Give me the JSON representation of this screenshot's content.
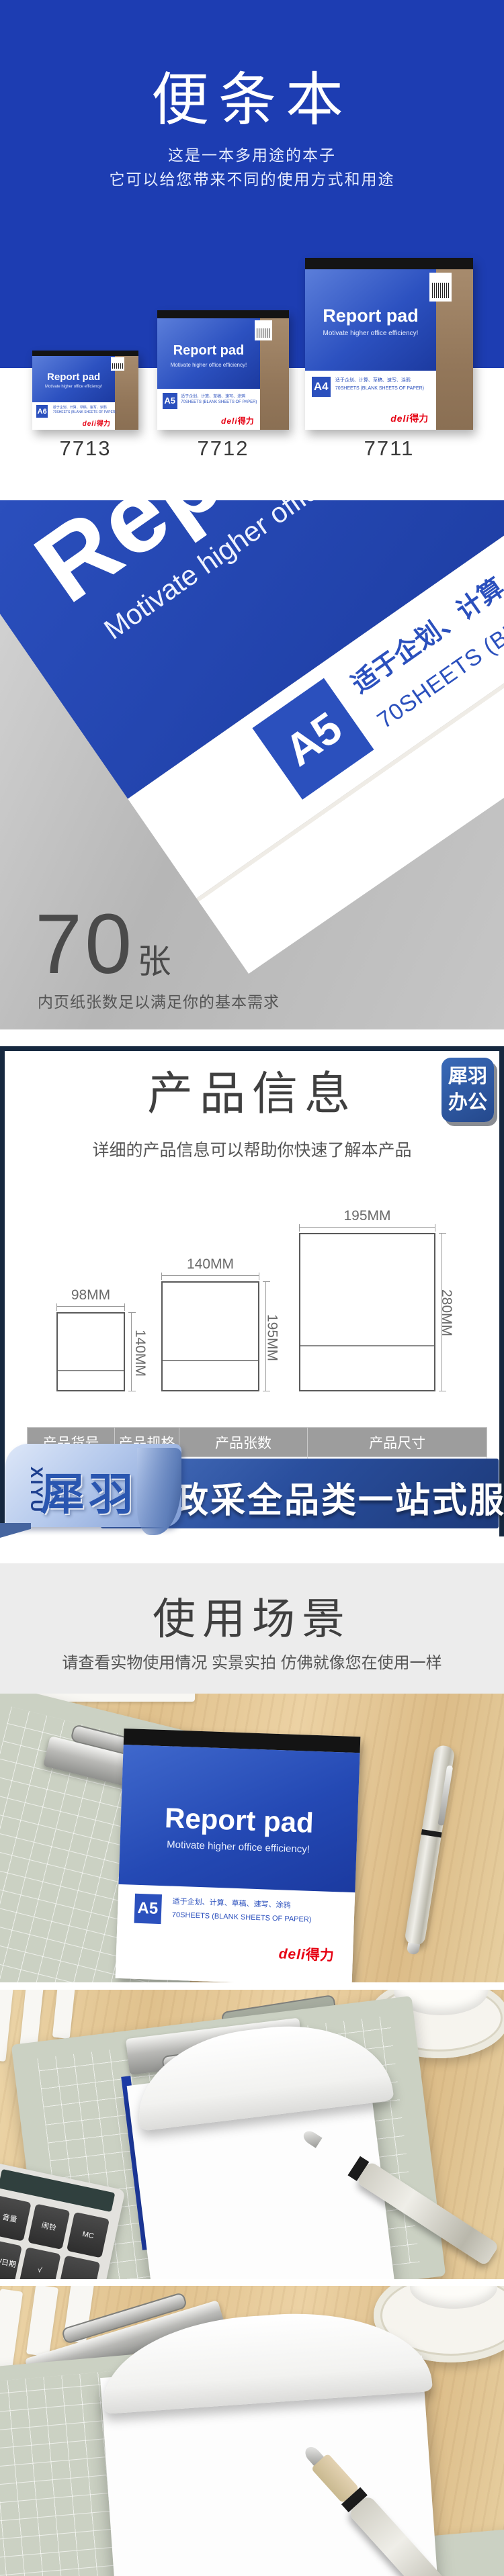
{
  "hero": {
    "title": "便条本",
    "subtitle1": "这是一本多用途的本子",
    "subtitle2": "它可以给您带来不同的使用方式和用途"
  },
  "product": {
    "cover_title": "Report pad",
    "cover_tagline": "Motivate higher office efficiency!",
    "usage_line": "适于企划、计算、草稿、速写、涂鸦",
    "sheets_line": "70SHEETS (BLANK SHEETS OF PAPER)",
    "brand_en": "deli",
    "brand_cn": "得力"
  },
  "models": [
    {
      "code": "7713",
      "size": "A6"
    },
    {
      "code": "7712",
      "size": "A5"
    },
    {
      "code": "7711",
      "size": "A4"
    }
  ],
  "feature": {
    "count": "70",
    "unit": "张",
    "desc": "内页纸张数足以满足你的基本需求",
    "badge_size": "A5"
  },
  "info": {
    "title": "产品信息",
    "subtitle": "详细的产品信息可以帮助你快速了解本产品",
    "badge_line1": "犀羽",
    "badge_line2": "办公"
  },
  "diagram": {
    "sizes": [
      {
        "w": "98MM",
        "h": "140MM"
      },
      {
        "w": "140MM",
        "h": "195MM"
      },
      {
        "w": "195MM",
        "h": "280MM"
      }
    ]
  },
  "spec_table": {
    "headers": [
      "产品货号",
      "产品规格",
      "产品张数",
      "产品尺寸"
    ],
    "row": [
      "",
      "",
      "70张/本",
      "195 X 280"
    ]
  },
  "banner": {
    "brand_vertical": "XIYU",
    "brand": "犀羽",
    "slogan": "政采全品类一站式服务"
  },
  "scene": {
    "title": "使用场景",
    "subtitle": "请查看实物使用情况 实景实拍 仿佛就像您在使用一样"
  },
  "calculator": {
    "keys": [
      "音量",
      "闹铃",
      "MC",
      "时间/日期",
      "√",
      ""
    ]
  },
  "colors": {
    "hero_blue": "#1d3db2",
    "cover_blue": "#2b50bd",
    "navy_border": "#16283f",
    "banner_blue": "#2a4f9e",
    "ribbon_light": "#b5c9ec",
    "brand_red": "#e60012",
    "table_header_gray": "#9d9d9d"
  }
}
